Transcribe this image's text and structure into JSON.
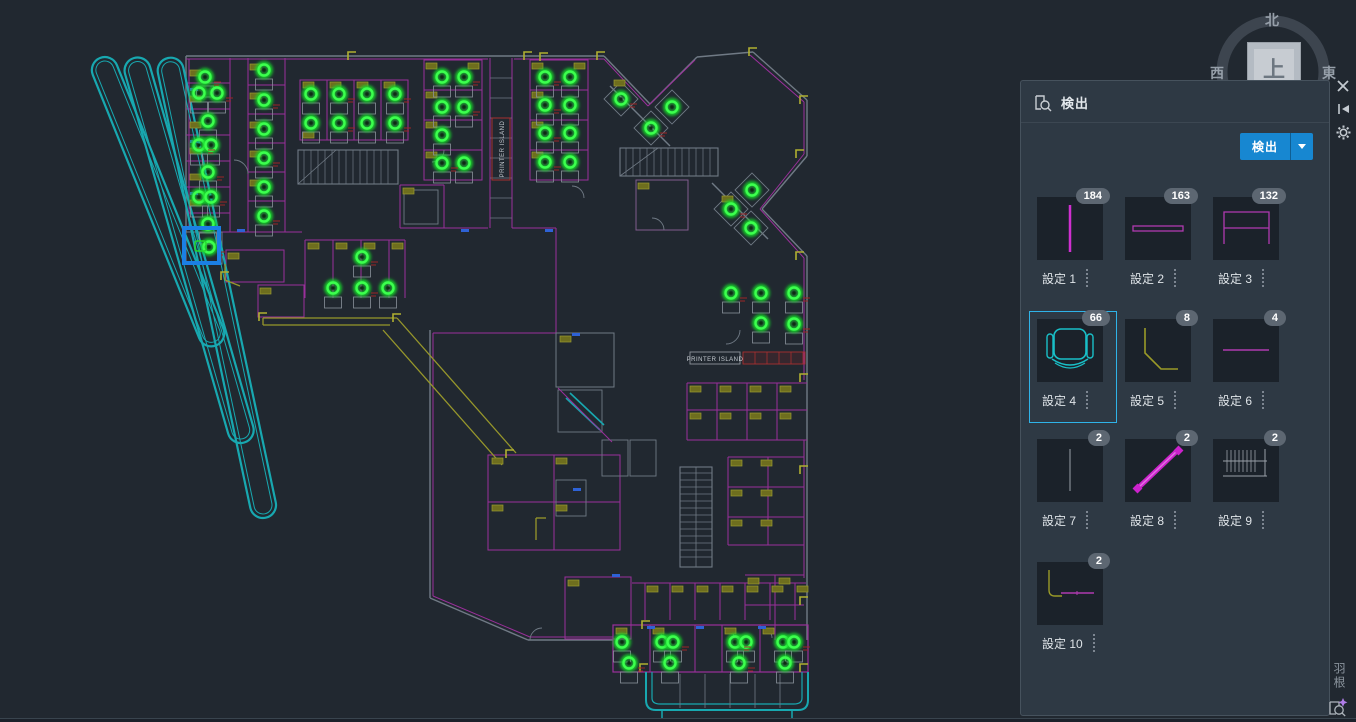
{
  "panel": {
    "title": "検出",
    "detect_button_label": "検出",
    "items": [
      {
        "label": "設定 1",
        "count": 184,
        "thumb": "vline-magenta",
        "selected": false
      },
      {
        "label": "設定 2",
        "count": 163,
        "thumb": "hbar-magenta",
        "selected": false
      },
      {
        "label": "設定 3",
        "count": 132,
        "thumb": "table-magenta",
        "selected": false
      },
      {
        "label": "設定 4",
        "count": 66,
        "thumb": "chair-cyan",
        "selected": true
      },
      {
        "label": "設定 5",
        "count": 8,
        "thumb": "corner-olive",
        "selected": false
      },
      {
        "label": "設定 6",
        "count": 4,
        "thumb": "hline-magenta",
        "selected": false
      },
      {
        "label": "設定 7",
        "count": 2,
        "thumb": "vline-gray",
        "selected": false
      },
      {
        "label": "設定 8",
        "count": 2,
        "thumb": "diag-magenta",
        "selected": false
      },
      {
        "label": "設定 9",
        "count": 2,
        "thumb": "hatch-gray",
        "selected": false
      },
      {
        "label": "設定 10",
        "count": 2,
        "thumb": "bench-olive",
        "selected": false
      }
    ]
  },
  "compass": {
    "north": "北",
    "west": "西",
    "east": "東",
    "up_button": "上"
  },
  "window_icons": {
    "close": "close-icon",
    "collapse": "collapse-panel-icon",
    "settings": "gear-icon"
  },
  "side_label": "羽根",
  "drawing": {
    "printer_island_vertical": "PRINTER ISLAND",
    "printer_island_horizontal": "PRINTER ISLAND",
    "selection_box": {
      "x": 184,
      "y": 228,
      "w": 35,
      "h": 35
    },
    "detections": [
      [
        205,
        77
      ],
      [
        199,
        93
      ],
      [
        217,
        93
      ],
      [
        208,
        121
      ],
      [
        199,
        145
      ],
      [
        211,
        145
      ],
      [
        208,
        172
      ],
      [
        199,
        197
      ],
      [
        211,
        197
      ],
      [
        208,
        224
      ],
      [
        209,
        247,
        1
      ],
      [
        264,
        70
      ],
      [
        264,
        100
      ],
      [
        264,
        129
      ],
      [
        264,
        158
      ],
      [
        264,
        187
      ],
      [
        264,
        216
      ],
      [
        311,
        94
      ],
      [
        339,
        94
      ],
      [
        367,
        94
      ],
      [
        395,
        94
      ],
      [
        311,
        123
      ],
      [
        339,
        123
      ],
      [
        367,
        123
      ],
      [
        395,
        123
      ],
      [
        442,
        77
      ],
      [
        464,
        77
      ],
      [
        442,
        107
      ],
      [
        464,
        107
      ],
      [
        442,
        135
      ],
      [
        442,
        163
      ],
      [
        464,
        163
      ],
      [
        545,
        77
      ],
      [
        570,
        77
      ],
      [
        545,
        105
      ],
      [
        570,
        105
      ],
      [
        545,
        133
      ],
      [
        570,
        133
      ],
      [
        545,
        162
      ],
      [
        570,
        162
      ],
      [
        621,
        99,
        1
      ],
      [
        672,
        107,
        1
      ],
      [
        651,
        128,
        1
      ],
      [
        752,
        190,
        1
      ],
      [
        731,
        209,
        1
      ],
      [
        751,
        228,
        1
      ],
      [
        362,
        257
      ],
      [
        333,
        288
      ],
      [
        362,
        288
      ],
      [
        388,
        288
      ],
      [
        731,
        293
      ],
      [
        761,
        293
      ],
      [
        794,
        293
      ],
      [
        761,
        323
      ],
      [
        794,
        324
      ],
      [
        622,
        642
      ],
      [
        629,
        663
      ],
      [
        662,
        642
      ],
      [
        673,
        642
      ],
      [
        670,
        663
      ],
      [
        735,
        642
      ],
      [
        746,
        642
      ],
      [
        739,
        663
      ],
      [
        783,
        642
      ],
      [
        794,
        642
      ],
      [
        785,
        663
      ]
    ]
  },
  "colors": {
    "accent_blue": "#1787d1",
    "selection_cyan": "#2fb3e8",
    "detect_green": "#2bf03c",
    "wall_magenta": "#9b2f9b",
    "wall_gray": "#707a85",
    "cad_teal": "#18a8b0",
    "cad_olive": "#97972b",
    "select_box_blue": "#1b7fe4",
    "badge_gray": "#5d6772"
  }
}
